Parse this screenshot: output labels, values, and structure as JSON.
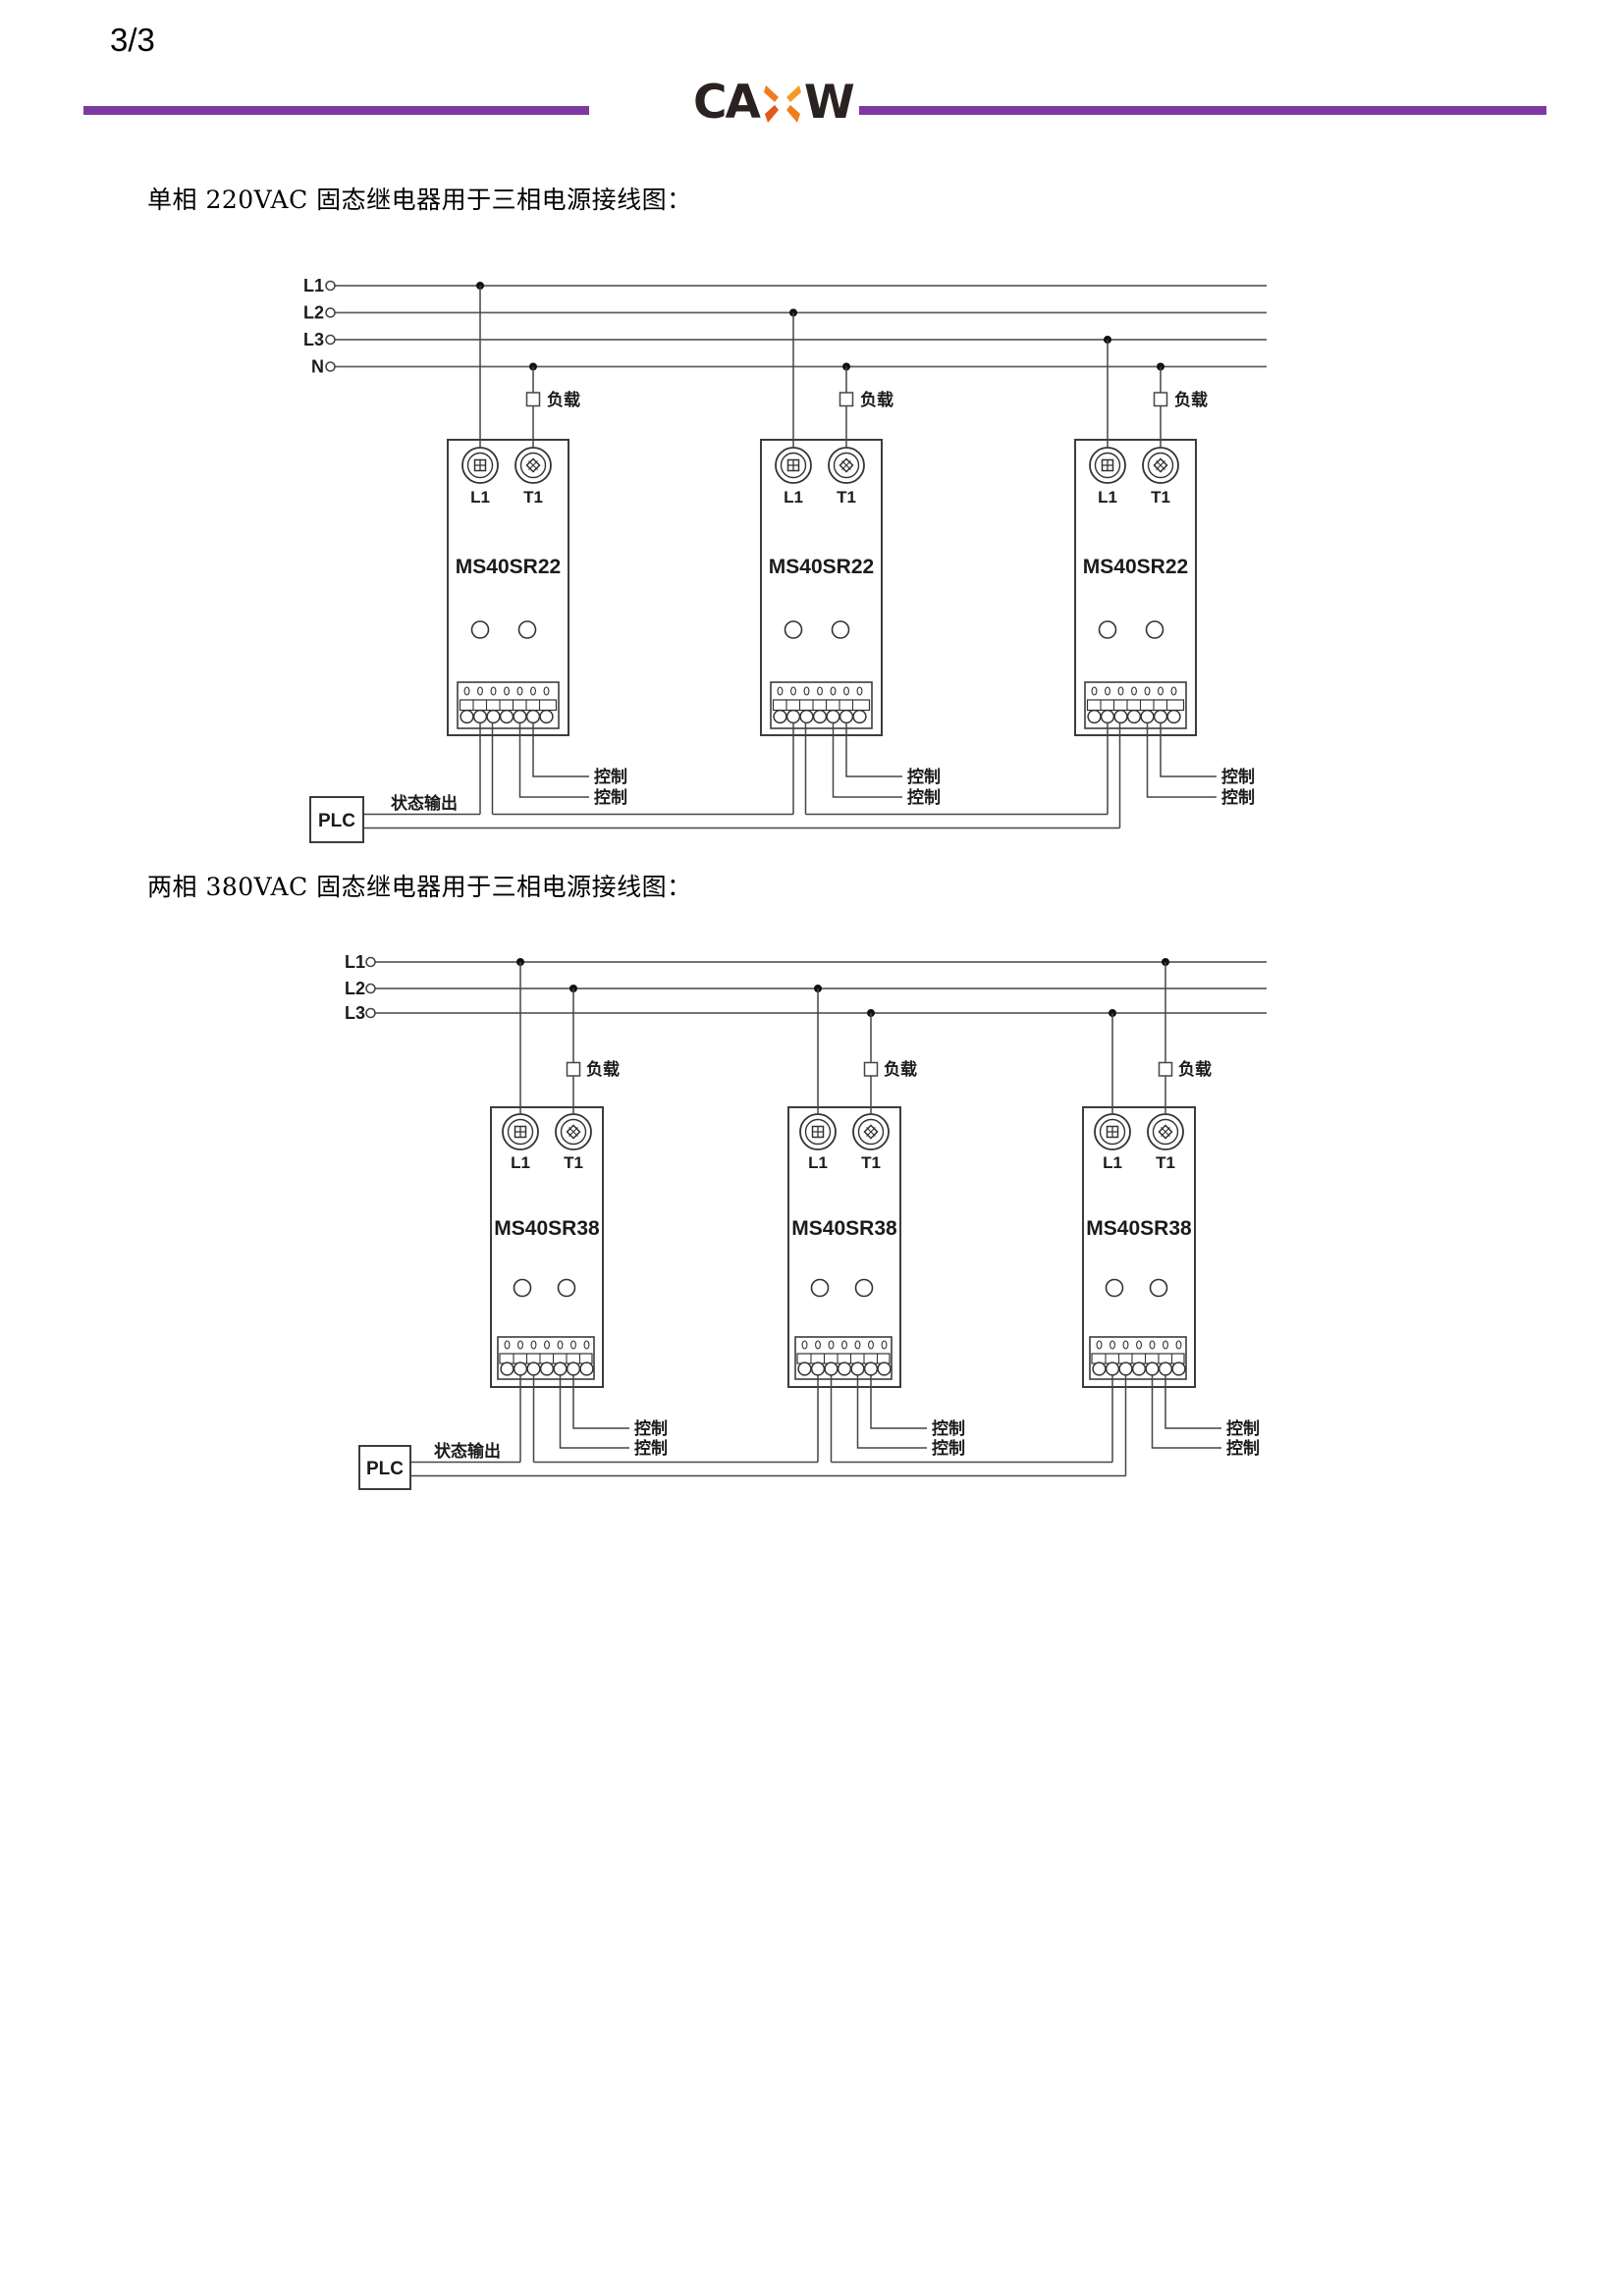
{
  "page": {
    "number": "3/3"
  },
  "header": {
    "logo": {
      "left": "CA",
      "right": "W"
    },
    "colors": {
      "rule": "#7c3aa0",
      "logo_text": "#2a2220",
      "logo_x_light": "#f59b23",
      "logo_x_mid": "#f07d1d",
      "logo_x_dark": "#e4571c"
    }
  },
  "diagram1": {
    "title": "单相 220VAC 固态继电器用于三相电源接线图：",
    "bus_labels": [
      "L1",
      "L2",
      "L3",
      "N"
    ],
    "plc_label": "PLC",
    "status_output_label": "状态输出",
    "modules": [
      {
        "model": "MS40SR22",
        "terminal_left": "L1",
        "terminal_right": "T1",
        "load_label": "负载",
        "control_labels": [
          "控制",
          "控制"
        ]
      },
      {
        "model": "MS40SR22",
        "terminal_left": "L1",
        "terminal_right": "T1",
        "load_label": "负载",
        "control_labels": [
          "控制",
          "控制"
        ]
      },
      {
        "model": "MS40SR22",
        "terminal_left": "L1",
        "terminal_right": "T1",
        "load_label": "负载",
        "control_labels": [
          "控制",
          "控制"
        ]
      }
    ]
  },
  "diagram2": {
    "title": "两相 380VAC 固态继电器用于三相电源接线图：",
    "bus_labels": [
      "L1",
      "L2",
      "L3"
    ],
    "plc_label": "PLC",
    "status_output_label": "状态输出",
    "modules": [
      {
        "model": "MS40SR38",
        "terminal_left": "L1",
        "terminal_right": "T1",
        "load_label": "负载",
        "control_labels": [
          "控制",
          "控制"
        ]
      },
      {
        "model": "MS40SR38",
        "terminal_left": "L1",
        "terminal_right": "T1",
        "load_label": "负载",
        "control_labels": [
          "控制",
          "控制"
        ]
      },
      {
        "model": "MS40SR38",
        "terminal_left": "L1",
        "terminal_right": "T1",
        "load_label": "负载",
        "control_labels": [
          "控制",
          "控制"
        ]
      }
    ]
  }
}
